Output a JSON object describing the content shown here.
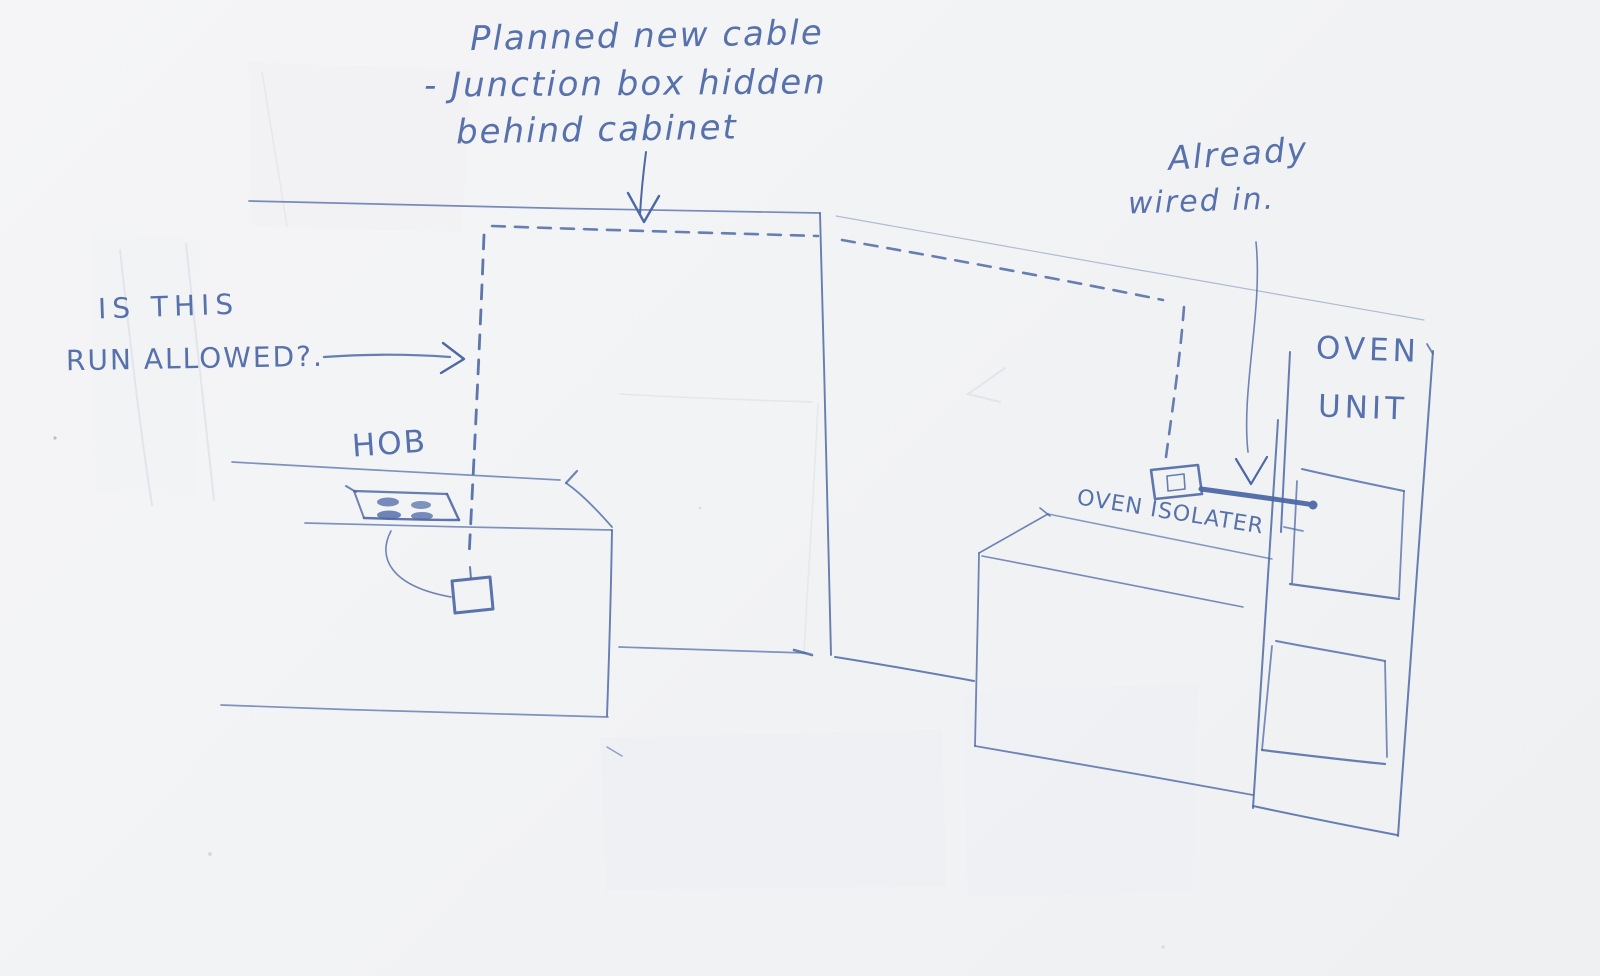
{
  "sketch": {
    "planned_note": {
      "line1": "Planned new cable",
      "line2": "- Junction box hidden",
      "line3": "behind cabinet"
    },
    "question_note": {
      "line1": "IS THIS",
      "line2": "RUN ALLOWED?."
    },
    "already_note": {
      "line1": "Already",
      "line2": "wired in."
    },
    "labels": {
      "hob": "HOB",
      "oven_isolator": "OVEN ISOLATER",
      "oven_unit_line1": "OVEN",
      "oven_unit_line2": "UNIT"
    },
    "colors": {
      "ink": "#4d68a6",
      "ink_dark": "#3f5a9e",
      "paper": "#f3f4f6",
      "crease": "#dde1e8"
    }
  }
}
